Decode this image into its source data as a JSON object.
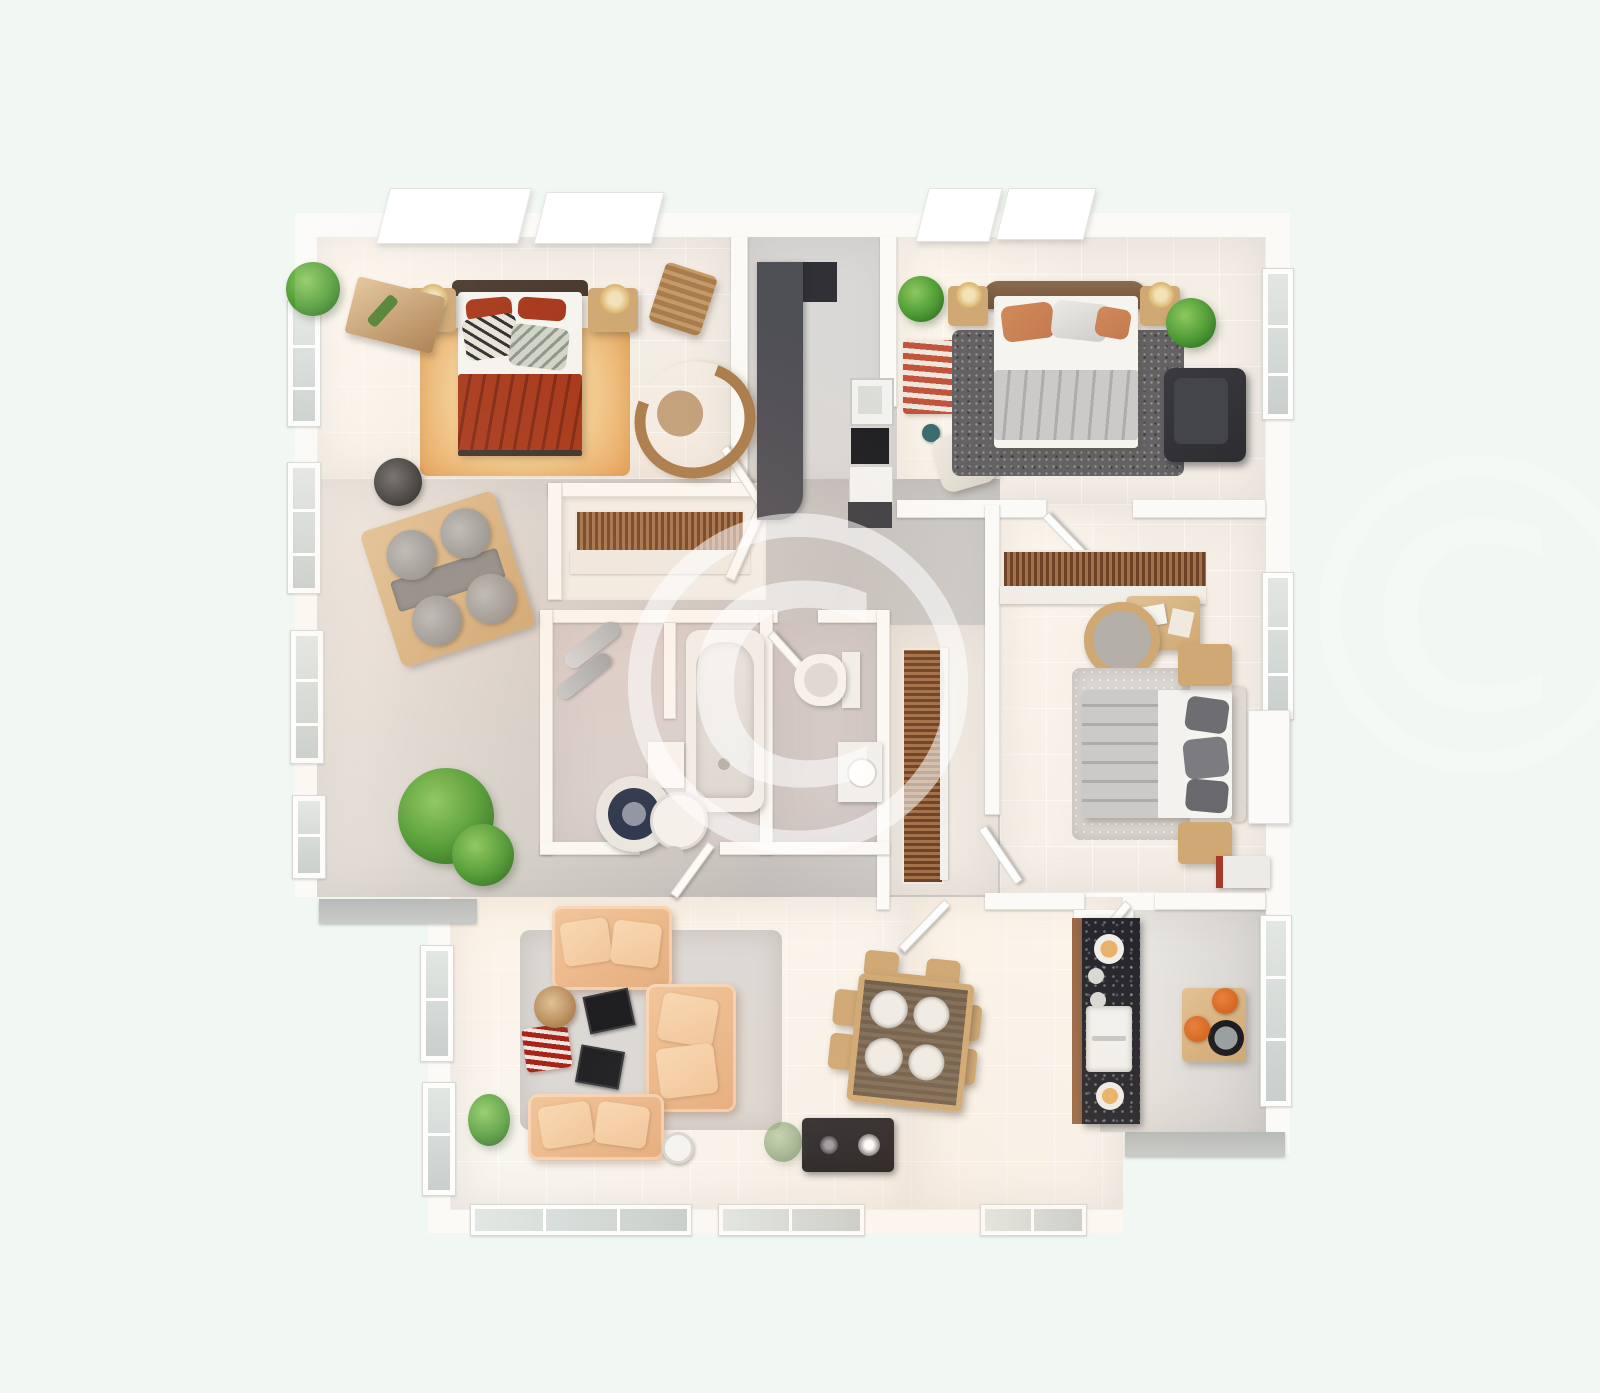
{
  "watermark": {
    "symbol": "©"
  },
  "palette": {
    "bg": "#f1f7f2",
    "wallFill": "#fbfaf7",
    "wallEdge": "#e3e1dc",
    "floorWarm": "#f4eee6",
    "floorLight": "#f8f4ee",
    "floorGray": "#d5d2cf",
    "floorGrayDark": "#c5c2bf",
    "floorMauve": "#d8d1d0",
    "floorWc": "#d2cac9",
    "corridorGray": "#dad8d6",
    "rugOrange": "#f2c98c",
    "rugOrangeDeep": "#e8a75f",
    "bedRed": "#a63517",
    "bedRedDark": "#7e2410",
    "headboardDark": "#46362b",
    "sheetWhite": "#f6f4ef",
    "woodLight": "#e2c195",
    "woodMid": "#cfa873",
    "woodDark": "#a97c4b",
    "slatDark": "#6e4226",
    "slatLight": "#a2714a",
    "grayBed": "#cbcac8",
    "grayBedDark": "#aeadaa",
    "pillowOrange": "#c2794e",
    "rugCharcoal": "#656264",
    "chairBlack": "#2c2c31",
    "sofaPeach": "#f2c69b",
    "sofaPeachDeep": "#e5ad7e",
    "rugRed": "#a8231b",
    "rugRedLight": "#efe6dc",
    "plantLight": "#8cc95e",
    "plantGreen": "#4e9a35",
    "plantDark": "#2c6420",
    "counterDark": "#4f4f56",
    "counterDarker": "#303036",
    "granite": "#26262c",
    "graniteEdge": "#9a6a48",
    "stoolOrange": "#d2641f",
    "glass": "#e2e7e4",
    "glassDark": "#c9cfcc",
    "ledge": "#b7bab8",
    "lampGold": "#d8b36a",
    "applianceBlack": "#1d1d21",
    "watermark": "rgba(255,255,255,0.55)",
    "watermarkFaint": "rgba(255,255,255,0.33)"
  },
  "scene": {
    "type": "3d-floor-plan-render",
    "rooms": [
      {
        "id": "bedroom-top-left",
        "items": [
          "double-bed-red",
          "rug-orange",
          "nightstand-left",
          "nightstand-right",
          "console-table",
          "desk-chair",
          "rocking-chair",
          "potted-plant",
          "round-stool"
        ]
      },
      {
        "id": "kitchen-corridor",
        "items": [
          "dark-counter",
          "cooktop",
          "fridge"
        ]
      },
      {
        "id": "bedroom-top-right",
        "items": [
          "double-bed-gray",
          "rug-charcoal",
          "armchair-black",
          "nightstand-left",
          "nightstand-right",
          "potted-plant",
          "striped-runner",
          "vanity-chair"
        ]
      },
      {
        "id": "hallway",
        "items": [
          "table-with-gray-chairs",
          "slatted-wardrobe",
          "potted-tree",
          "window-plants"
        ]
      },
      {
        "id": "bathroom",
        "items": [
          "bathtub",
          "washing-machine",
          "round-basin",
          "towel-rolls",
          "side-table"
        ]
      },
      {
        "id": "wc",
        "items": [
          "toilet",
          "vanity-basin"
        ]
      },
      {
        "id": "wardrobe-corridor",
        "items": [
          "slatted-shelving"
        ]
      },
      {
        "id": "bedroom-right",
        "items": [
          "double-bed-gray-white",
          "slatted-wardrobe",
          "desk",
          "round-chair",
          "nightstand-top",
          "nightstand-bottom",
          "rug-gray",
          "cabinet-red-edge"
        ]
      },
      {
        "id": "living-room",
        "items": [
          "sofa-top",
          "sofa-right",
          "sofa-bottom",
          "rug-red-striped",
          "round-side-table",
          "decor-trays",
          "tv-unit-black",
          "potted-tree",
          "potted-plant",
          "round-cup"
        ]
      },
      {
        "id": "dining-area",
        "items": [
          "dining-table-four-plates",
          "wood-chairs"
        ]
      },
      {
        "id": "kitchen",
        "items": [
          "granite-counter",
          "sink",
          "plates",
          "breakfast-table",
          "orange-stools",
          "round-tray"
        ]
      }
    ]
  }
}
